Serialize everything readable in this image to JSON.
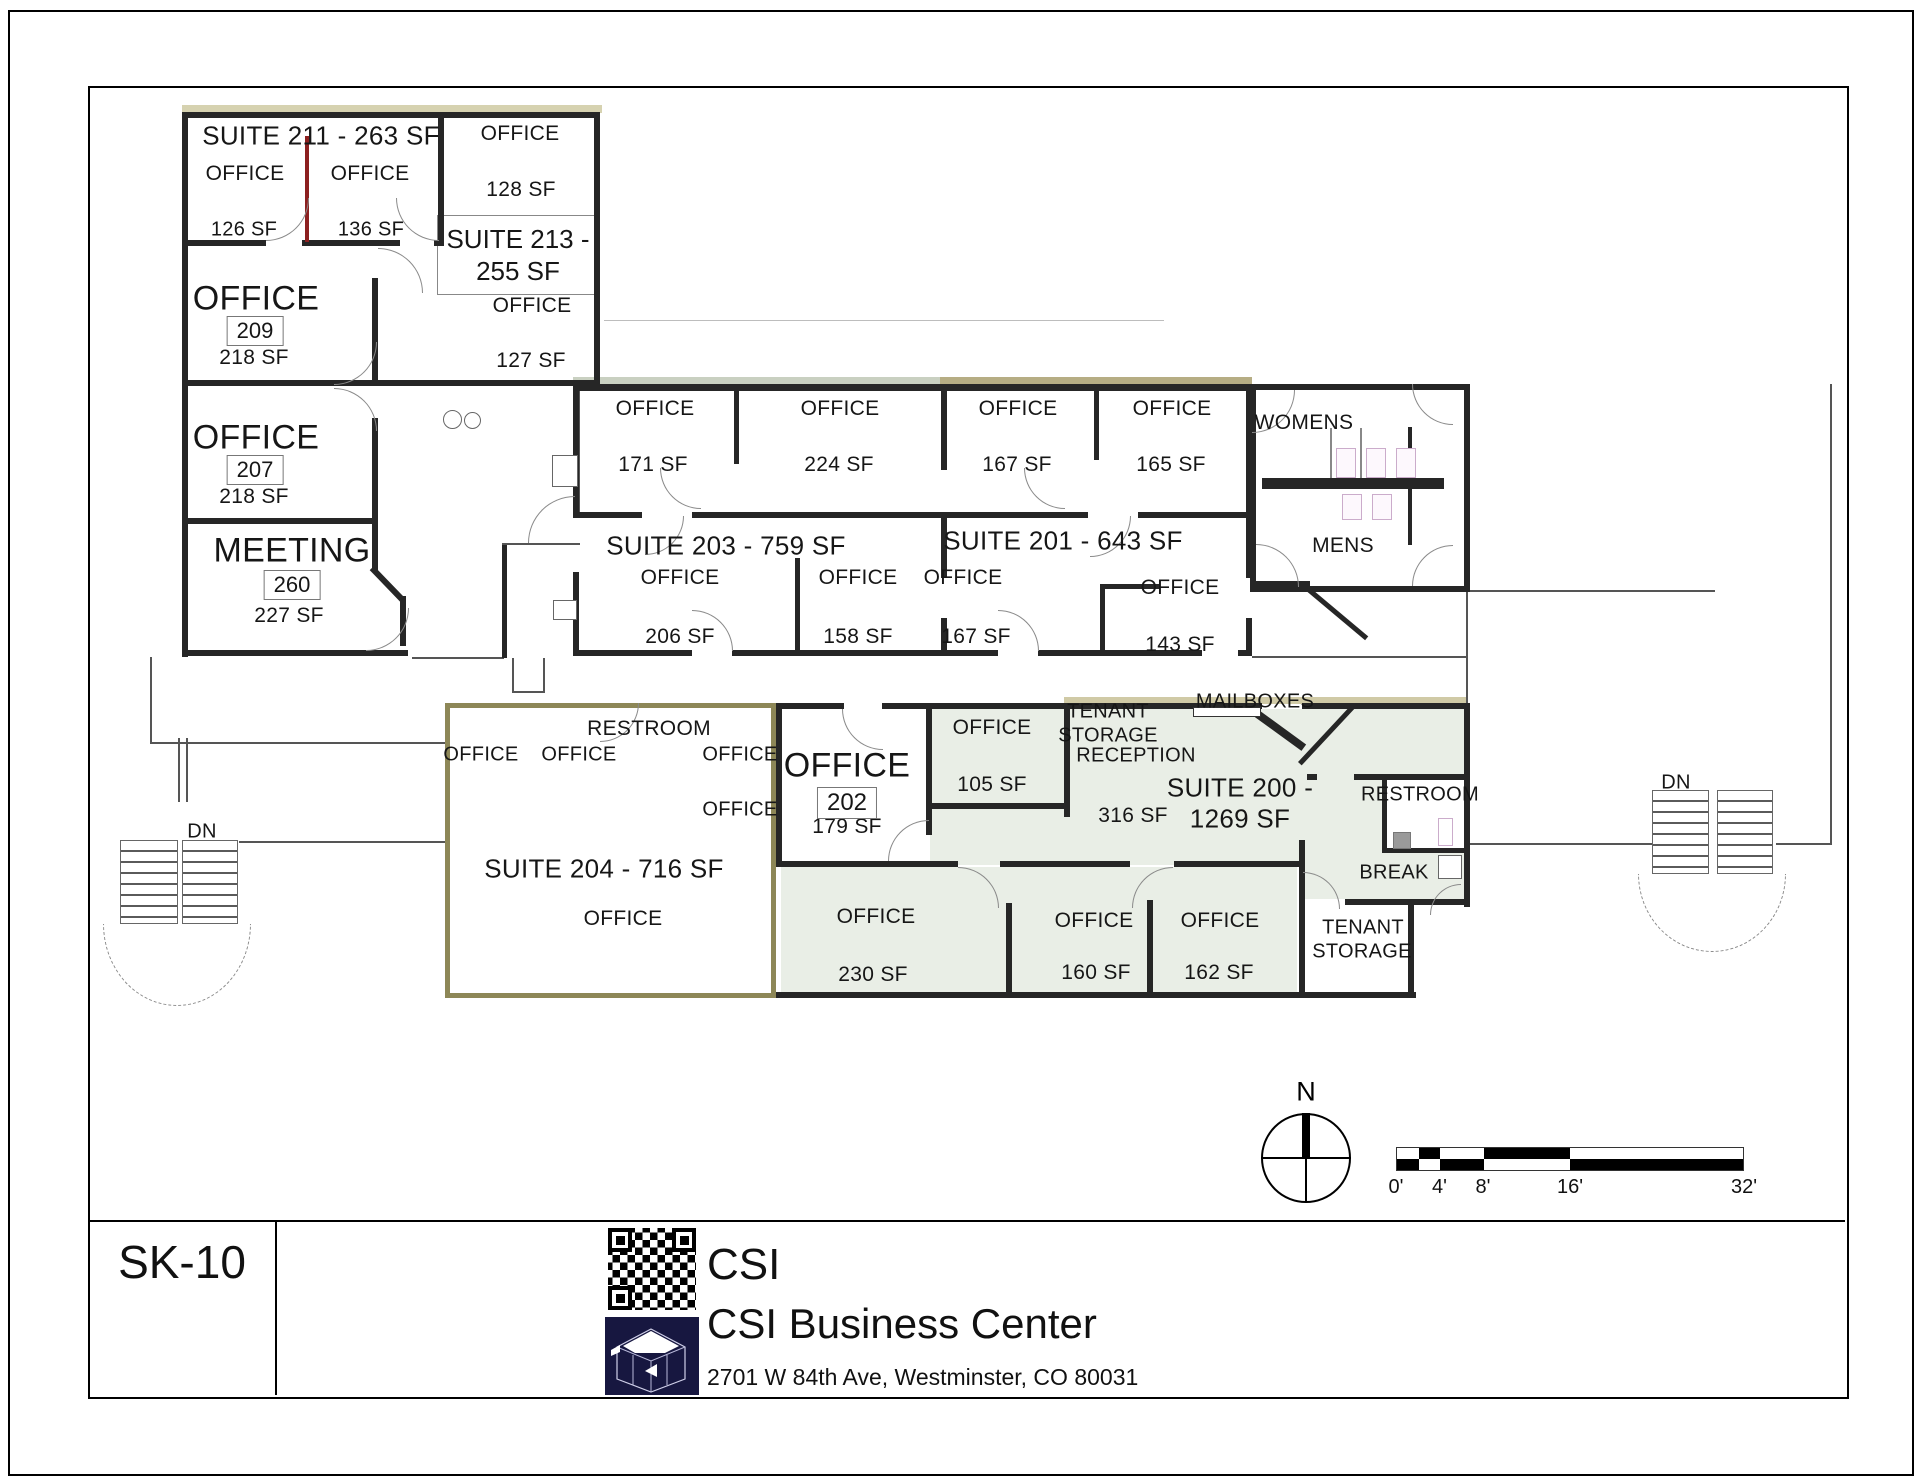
{
  "sheet": {
    "code": "SK-10",
    "company": "CSI",
    "project": "CSI Business Center",
    "address": "2701 W 84th Ave, Westminster, CO 80031"
  },
  "compass": {
    "north_label": "N"
  },
  "scale_bar": {
    "tick_labels": [
      "0'",
      "4'",
      "8'",
      "16'",
      "32'"
    ],
    "tick_positions": [
      0,
      0.125,
      0.25,
      0.5,
      1
    ],
    "segment_bounds": [
      0,
      0.0625,
      0.125,
      0.25,
      0.5,
      1
    ],
    "colors": {
      "dark": "#000000",
      "light": "#ffffff"
    }
  },
  "plan": {
    "suite_213_box": {
      "line1": "SUITE 213 -",
      "line2": "255 SF"
    },
    "boxed_room_numbers": [
      {
        "t": "209",
        "x": 255,
        "y": 331,
        "s": 22
      },
      {
        "t": "207",
        "x": 255,
        "y": 470,
        "s": 22
      },
      {
        "t": "260",
        "x": 292,
        "y": 585,
        "s": 22
      },
      {
        "t": "202",
        "x": 847,
        "y": 803,
        "s": 24
      }
    ],
    "labels": [
      {
        "t": "SUITE 211 - 263 SF",
        "x": 321,
        "y": 136,
        "s": 26,
        "n": "suite-211-title"
      },
      {
        "t": "OFFICE",
        "x": 245,
        "y": 174,
        "s": 21,
        "n": "office-label"
      },
      {
        "t": "OFFICE",
        "x": 370,
        "y": 174,
        "s": 21,
        "n": "office-label"
      },
      {
        "t": "126 SF",
        "x": 244,
        "y": 230,
        "s": 20,
        "n": "area-label"
      },
      {
        "t": "136 SF",
        "x": 371,
        "y": 230,
        "s": 20,
        "n": "area-label"
      },
      {
        "t": "OFFICE",
        "x": 520,
        "y": 134,
        "s": 21,
        "n": "office-label"
      },
      {
        "t": "128 SF",
        "x": 521,
        "y": 190,
        "s": 21,
        "n": "area-label"
      },
      {
        "t": "OFFICE",
        "x": 532,
        "y": 306,
        "s": 21,
        "n": "office-label"
      },
      {
        "t": "127 SF",
        "x": 531,
        "y": 361,
        "s": 21,
        "n": "area-label"
      },
      {
        "t": "OFFICE",
        "x": 256,
        "y": 299,
        "s": 34,
        "n": "office-label"
      },
      {
        "t": "218 SF",
        "x": 254,
        "y": 358,
        "s": 21,
        "n": "area-label"
      },
      {
        "t": "OFFICE",
        "x": 256,
        "y": 438,
        "s": 34,
        "n": "office-label"
      },
      {
        "t": "218 SF",
        "x": 254,
        "y": 497,
        "s": 21,
        "n": "area-label"
      },
      {
        "t": "MEETING",
        "x": 292,
        "y": 551,
        "s": 34,
        "n": "meeting-label"
      },
      {
        "t": "227 SF",
        "x": 289,
        "y": 616,
        "s": 21,
        "n": "area-label"
      },
      {
        "t": "OFFICE",
        "x": 655,
        "y": 409,
        "s": 21,
        "n": "office-label"
      },
      {
        "t": "171 SF",
        "x": 653,
        "y": 465,
        "s": 21,
        "n": "area-label"
      },
      {
        "t": "OFFICE",
        "x": 840,
        "y": 409,
        "s": 21,
        "n": "office-label"
      },
      {
        "t": "224 SF",
        "x": 839,
        "y": 465,
        "s": 21,
        "n": "area-label"
      },
      {
        "t": "OFFICE",
        "x": 1018,
        "y": 409,
        "s": 21,
        "n": "office-label"
      },
      {
        "t": "167 SF",
        "x": 1017,
        "y": 465,
        "s": 21,
        "n": "area-label"
      },
      {
        "t": "OFFICE",
        "x": 1172,
        "y": 409,
        "s": 21,
        "n": "office-label"
      },
      {
        "t": "165 SF",
        "x": 1171,
        "y": 465,
        "s": 21,
        "n": "area-label"
      },
      {
        "t": "WOMENS",
        "x": 1304,
        "y": 423,
        "s": 21,
        "n": "womens-label"
      },
      {
        "t": "MENS",
        "x": 1343,
        "y": 546,
        "s": 21,
        "n": "mens-label"
      },
      {
        "t": "SUITE 203 - 759 SF",
        "x": 726,
        "y": 546,
        "s": 26,
        "n": "suite-203-title"
      },
      {
        "t": "SUITE 201 - 643 SF",
        "x": 1063,
        "y": 541,
        "s": 26,
        "n": "suite-201-title"
      },
      {
        "t": "OFFICE",
        "x": 680,
        "y": 578,
        "s": 21,
        "n": "office-label"
      },
      {
        "t": "206 SF",
        "x": 680,
        "y": 637,
        "s": 21,
        "n": "area-label"
      },
      {
        "t": "OFFICE",
        "x": 858,
        "y": 578,
        "s": 21,
        "n": "office-label"
      },
      {
        "t": "158 SF",
        "x": 858,
        "y": 637,
        "s": 21,
        "n": "area-label"
      },
      {
        "t": "OFFICE",
        "x": 963,
        "y": 578,
        "s": 21,
        "n": "office-label"
      },
      {
        "t": "167 SF",
        "x": 976,
        "y": 637,
        "s": 21,
        "n": "area-label"
      },
      {
        "t": "OFFICE",
        "x": 1180,
        "y": 588,
        "s": 21,
        "n": "office-label"
      },
      {
        "t": "143 SF",
        "x": 1180,
        "y": 645,
        "s": 21,
        "n": "area-label"
      },
      {
        "t": "RESTROOM",
        "x": 649,
        "y": 729,
        "s": 21,
        "n": "restroom-label"
      },
      {
        "t": "OFFICE",
        "x": 481,
        "y": 755,
        "s": 20,
        "n": "office-label"
      },
      {
        "t": "OFFICE",
        "x": 579,
        "y": 755,
        "s": 20,
        "n": "office-label"
      },
      {
        "t": "OFFICE",
        "x": 740,
        "y": 755,
        "s": 20,
        "n": "office-label"
      },
      {
        "t": "OFFICE",
        "x": 740,
        "y": 810,
        "s": 20,
        "n": "office-label"
      },
      {
        "t": "SUITE 204 - 716 SF",
        "x": 604,
        "y": 869,
        "s": 26,
        "n": "suite-204-title"
      },
      {
        "t": "OFFICE",
        "x": 623,
        "y": 919,
        "s": 21,
        "n": "office-label"
      },
      {
        "t": "OFFICE",
        "x": 847,
        "y": 766,
        "s": 34,
        "n": "office-label"
      },
      {
        "t": "179 SF",
        "x": 847,
        "y": 827,
        "s": 21,
        "n": "area-label"
      },
      {
        "t": "OFFICE",
        "x": 992,
        "y": 728,
        "s": 21,
        "n": "office-label"
      },
      {
        "t": "105 SF",
        "x": 992,
        "y": 785,
        "s": 21,
        "n": "area-label"
      },
      {
        "t": "TENANT",
        "x": 1108,
        "y": 712,
        "s": 20,
        "n": "tenant-storage-label"
      },
      {
        "t": "STORAGE",
        "x": 1108,
        "y": 736,
        "s": 20,
        "n": "tenant-storage-label"
      },
      {
        "t": "RECEPTION",
        "x": 1136,
        "y": 756,
        "s": 20,
        "n": "reception-label"
      },
      {
        "t": "316 SF",
        "x": 1133,
        "y": 816,
        "s": 21,
        "n": "area-label"
      },
      {
        "t": "MAILBOXES",
        "x": 1255,
        "y": 702,
        "s": 20,
        "n": "mailboxes-label"
      },
      {
        "t": "SUITE 200 -",
        "x": 1240,
        "y": 788,
        "s": 26,
        "n": "suite-200-title"
      },
      {
        "t": "1269 SF",
        "x": 1240,
        "y": 819,
        "s": 26,
        "n": "suite-200-title"
      },
      {
        "t": "RESTROOM",
        "x": 1420,
        "y": 795,
        "s": 20,
        "n": "restroom-label"
      },
      {
        "t": "BREAK",
        "x": 1394,
        "y": 873,
        "s": 20,
        "n": "break-label"
      },
      {
        "t": "TENANT",
        "x": 1363,
        "y": 928,
        "s": 20,
        "n": "tenant-storage-label"
      },
      {
        "t": "STORAGE",
        "x": 1362,
        "y": 952,
        "s": 20,
        "n": "tenant-storage-label"
      },
      {
        "t": "OFFICE",
        "x": 876,
        "y": 917,
        "s": 21,
        "n": "office-label"
      },
      {
        "t": "230 SF",
        "x": 873,
        "y": 975,
        "s": 21,
        "n": "area-label"
      },
      {
        "t": "OFFICE",
        "x": 1094,
        "y": 921,
        "s": 21,
        "n": "office-label"
      },
      {
        "t": "160 SF",
        "x": 1096,
        "y": 973,
        "s": 21,
        "n": "area-label"
      },
      {
        "t": "OFFICE",
        "x": 1220,
        "y": 921,
        "s": 21,
        "n": "office-label"
      },
      {
        "t": "162 SF",
        "x": 1219,
        "y": 973,
        "s": 21,
        "n": "area-label"
      },
      {
        "t": "DN",
        "x": 202,
        "y": 832,
        "s": 20,
        "n": "dn-label"
      },
      {
        "t": "DN",
        "x": 1676,
        "y": 783,
        "s": 20,
        "n": "dn-label"
      }
    ]
  }
}
